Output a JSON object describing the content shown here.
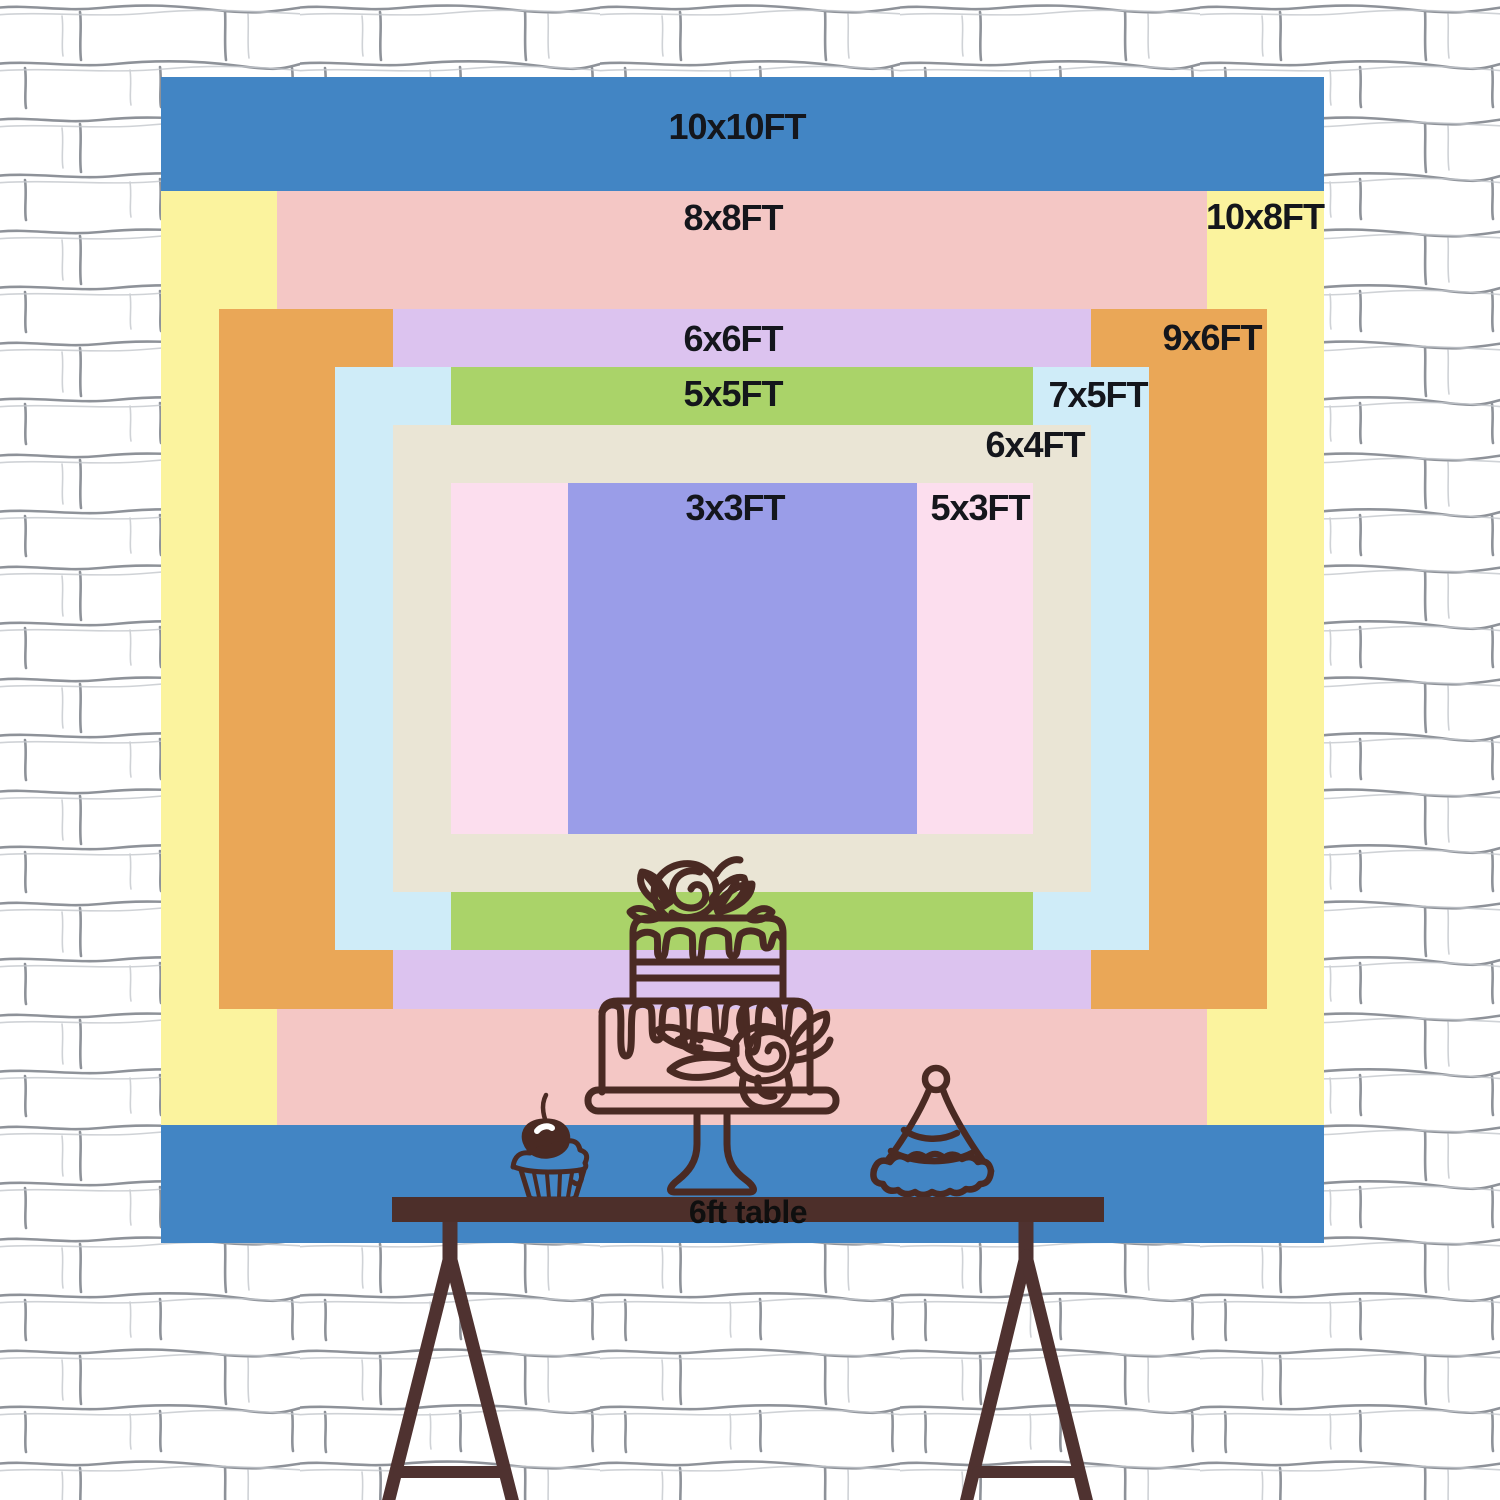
{
  "backdrop": {
    "sizes": [
      {
        "label": "10x10FT",
        "color": "#4285c4"
      },
      {
        "label": "8x8FT",
        "color": "#f4c7c5"
      },
      {
        "label": "10x8FT",
        "color": "#fbf39e"
      },
      {
        "label": "6x6FT",
        "color": "#dcc3ef"
      },
      {
        "label": "9x6FT",
        "color": "#eaa757"
      },
      {
        "label": "5x5FT",
        "color": "#aad369"
      },
      {
        "label": "7x5FT",
        "color": "#cfecf8"
      },
      {
        "label": "6x4FT",
        "color": "#eae5d5"
      },
      {
        "label": "3x3FT",
        "color": "#9a9de8"
      },
      {
        "label": "5x3FT",
        "color": "#fcdeee"
      }
    ]
  },
  "table": {
    "label": "6ft table",
    "color": "#4d2f2a"
  },
  "decor": {
    "line_color": "#4a2a23",
    "items": [
      "tiered-cake-icon",
      "cupcake-icon",
      "party-hat-icon"
    ]
  },
  "wall": {
    "style": "white-brick",
    "line_color": "#7a7f87"
  }
}
